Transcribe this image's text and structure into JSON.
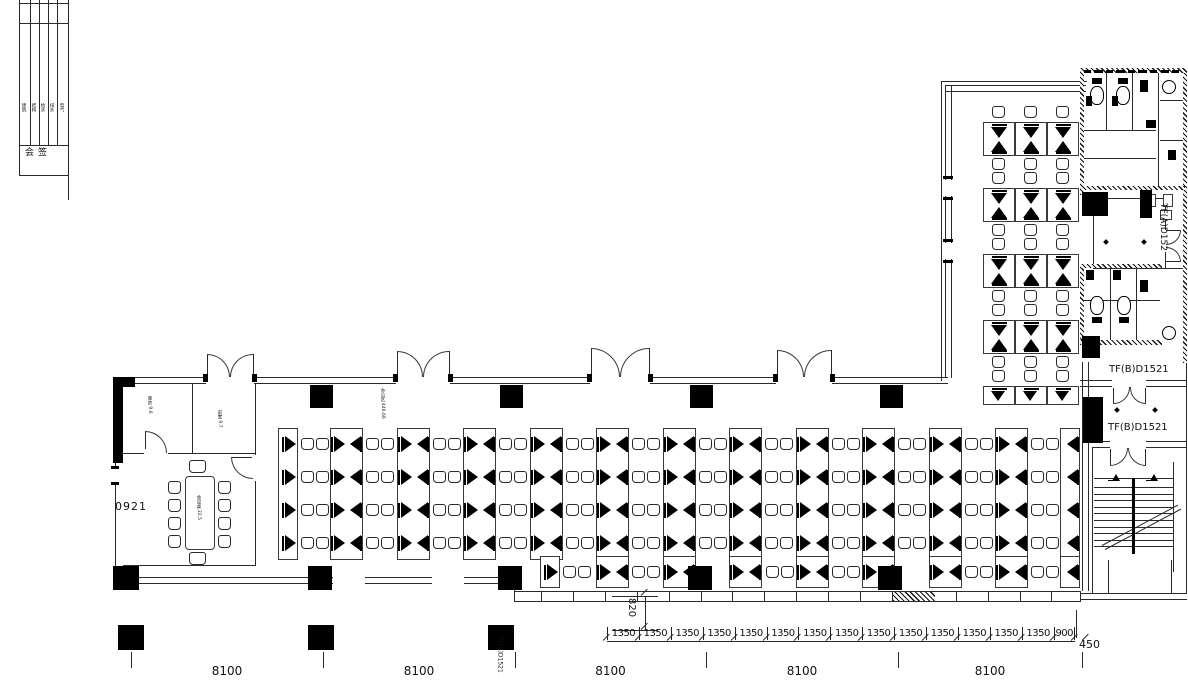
{
  "title_block": {
    "sign_label": "会签",
    "disciplines": [
      "建筑",
      "结构",
      "给水",
      "排水",
      "电气"
    ]
  },
  "labels": {
    "room_a": "库房 9.6",
    "room_b": "前室 9.7",
    "meeting_table": "会议桌 22.5",
    "office_area": "办公区 446.66",
    "door_code": "0921",
    "room_tfa": "TF(A)D152",
    "room_tfb_upper": "TF(B)D1521",
    "room_tfb_lower": "TF(B)D1521",
    "grid_tfb": "TF(B)D1521"
  },
  "dimensions": {
    "bays": [
      "8100",
      "8100",
      "8100",
      "8100",
      "8100"
    ],
    "modules": [
      "1350",
      "1350",
      "1350",
      "1350",
      "1350",
      "1350",
      "1350",
      "1350",
      "1350",
      "1350",
      "1350",
      "1350",
      "1350",
      "1350"
    ],
    "end_module": "900",
    "offset": "450",
    "depth": "820"
  }
}
